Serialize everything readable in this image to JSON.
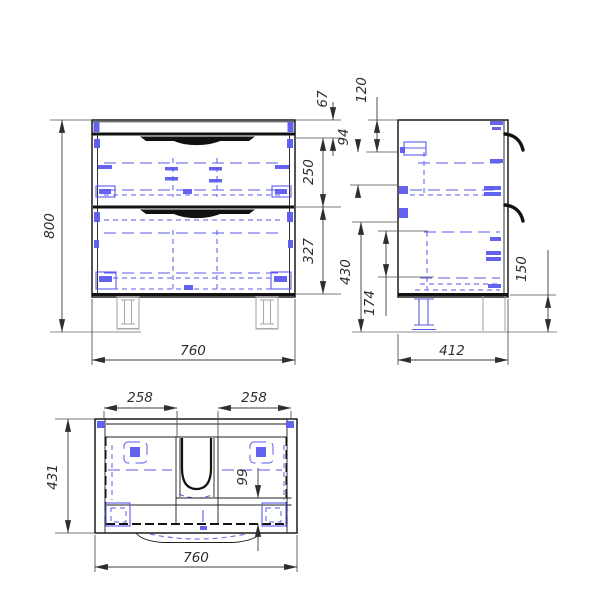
{
  "drawing": {
    "type": "cabinet-technical-drawing",
    "colors": {
      "outline": "#1c1c1c",
      "hidden_detail_blue": "#5b5bee",
      "dimension_lines": "#3c3c3c",
      "legs_gray": "#a9a9a9"
    },
    "views": {
      "front": {
        "dims": {
          "overall_height": "800",
          "top_rail": "67",
          "upper_drawer": "250",
          "lower_drawer": "327",
          "overall_width": "760"
        }
      },
      "side": {
        "dims": {
          "top_offset": "120",
          "bracket_offset": "94",
          "lower_zone": "430",
          "inner_offset": "174",
          "overall_depth": "412",
          "leg_height": "150"
        }
      },
      "top": {
        "dims": {
          "left_drawer_width": "258",
          "right_drawer_width": "258",
          "overall_depth": "431",
          "front_clearance": "99",
          "overall_width": "760"
        }
      }
    }
  }
}
